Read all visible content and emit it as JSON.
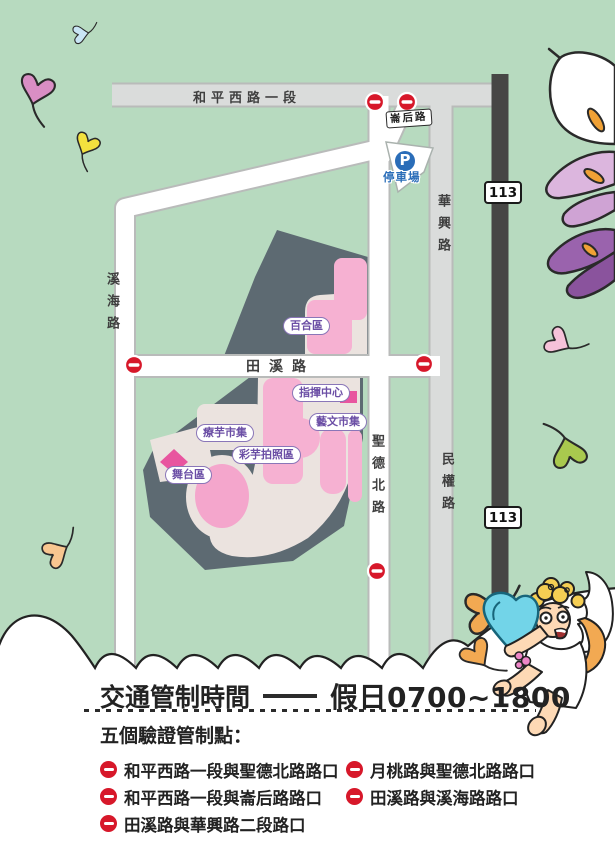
{
  "map": {
    "roads": {
      "heping": "和平西路一段",
      "lunhou": "崙后路",
      "huaxing": "華興路",
      "xihai": "溪海路",
      "tianxi": "田溪路",
      "shengdebei": "聖德北路",
      "minquan": "民權路",
      "highway_badge": "113"
    },
    "parking": {
      "icon_letter": "P",
      "label": "停車場"
    },
    "zones": [
      {
        "label": "百合區"
      },
      {
        "label": "指揮中心"
      },
      {
        "label": "藝文市集"
      },
      {
        "label": "療芋市集"
      },
      {
        "label": "彩芋拍照區"
      },
      {
        "label": "舞台區"
      }
    ]
  },
  "panel": {
    "control_time_label": "交通管制時間",
    "control_time_value": "假日0700~1800",
    "checkpoints_title": "五個驗證管制點：",
    "checkpoints": [
      "和平西路一段與聖德北路路口",
      "和平西路一段與崙后路路口",
      "田溪路與華興路二段路口",
      "月桃路與聖德北路路口",
      "田溪路與溪海路路口"
    ]
  },
  "colors": {
    "background_green": "#b7dabf",
    "road_white": "#ffffff",
    "road_gray": "#dadcdb",
    "road_casing": "#b9bbba",
    "highway_dark": "#474645",
    "venue_dark": "#5d6a72",
    "venue_pink": "#f6b1d2",
    "venue_light": "#ebe3df",
    "accent_magenta": "#e8559f",
    "no_entry_red": "#d7182a",
    "parking_blue": "#2a6db8",
    "zone_label_purple": "#6b4ea5"
  }
}
